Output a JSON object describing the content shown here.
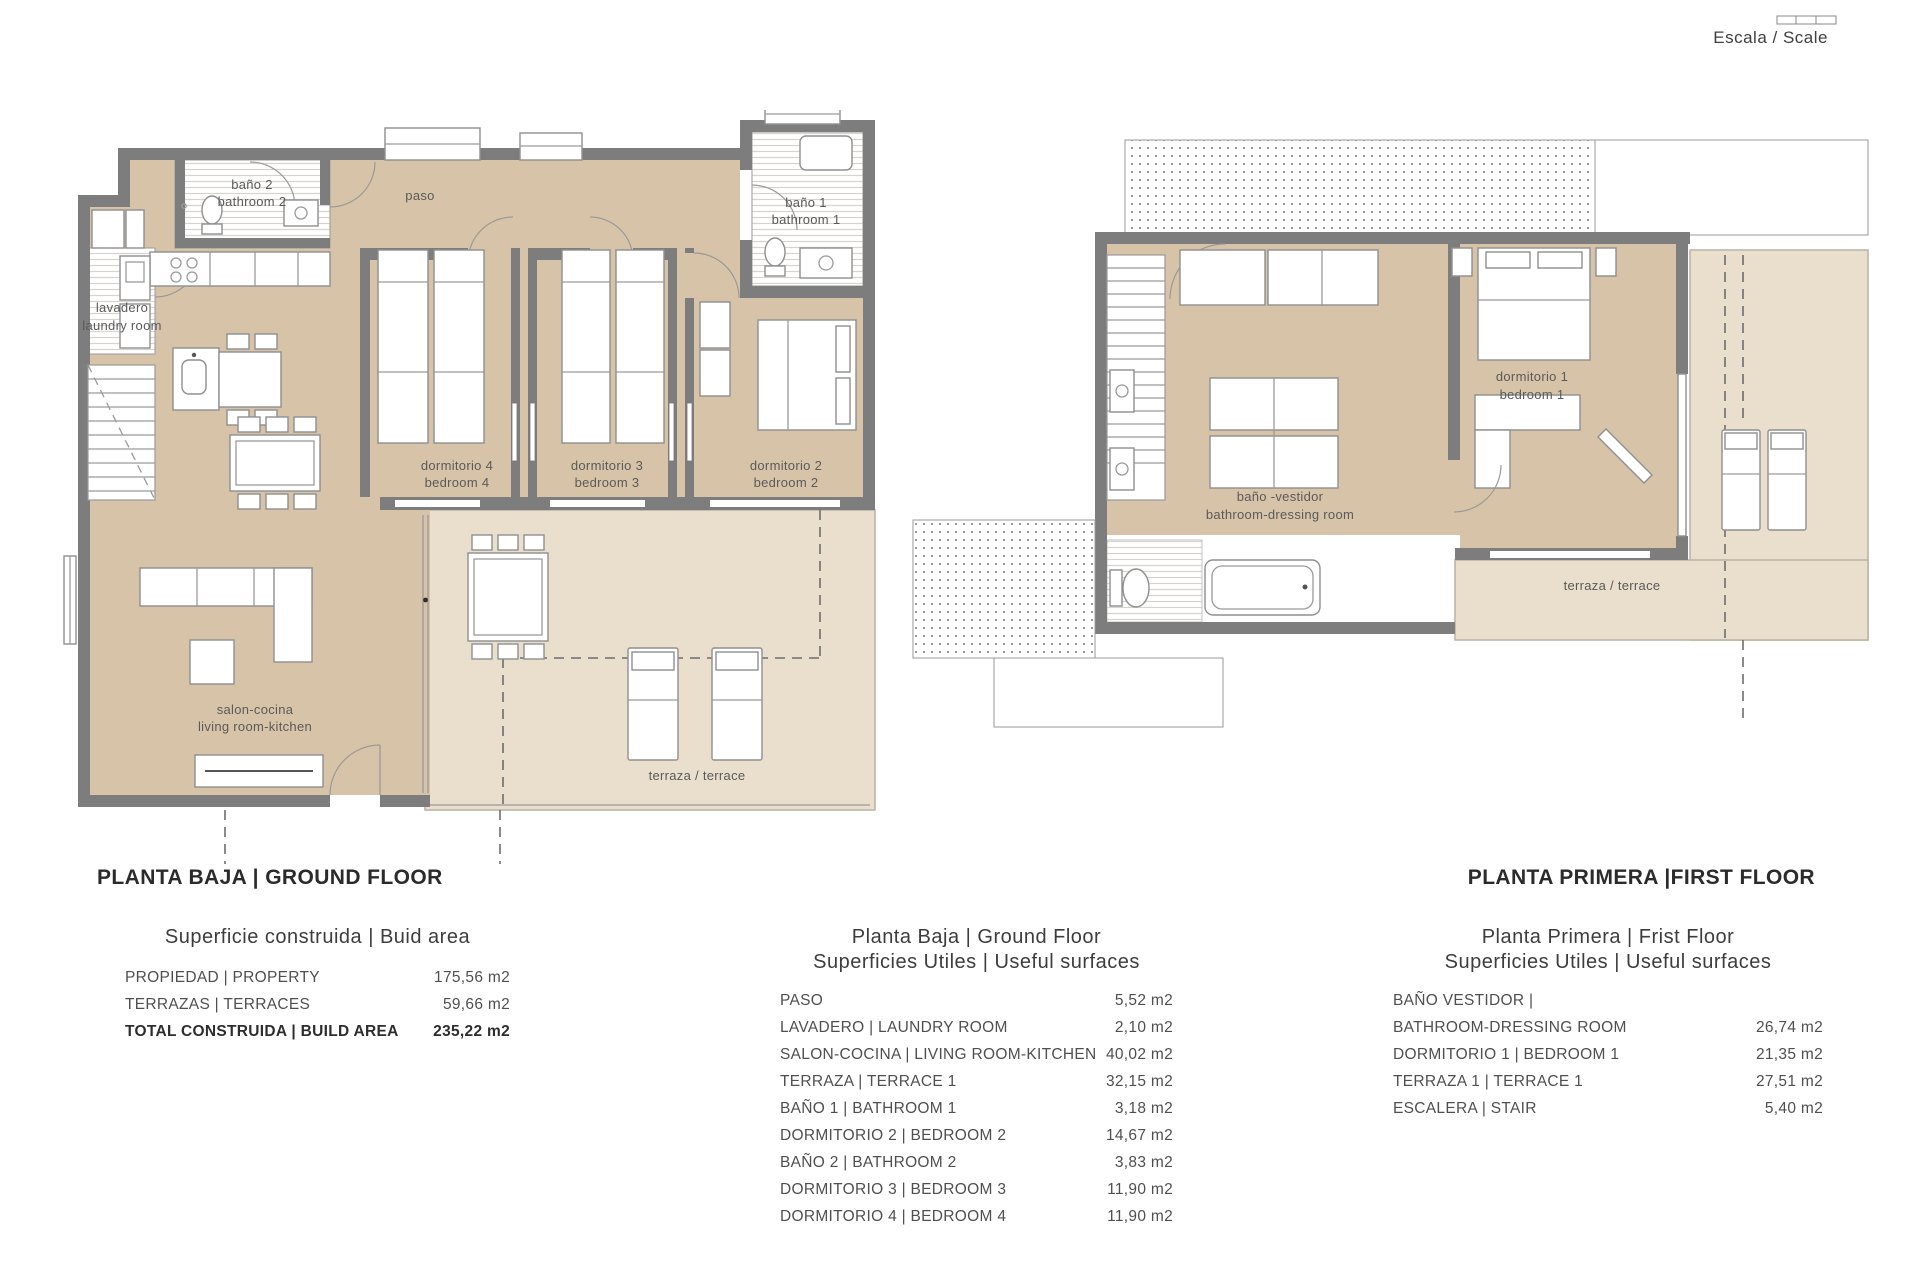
{
  "scale": {
    "label": "Escala / Scale"
  },
  "ground_floor": {
    "title": "PLANTA BAJA | GROUND FLOOR",
    "rooms": {
      "bath2": {
        "line1": "baño 2",
        "line2": "bathroom 2"
      },
      "paso": {
        "line1": "paso"
      },
      "bath1": {
        "line1": "baño 1",
        "line2": "bathroom 1"
      },
      "laundry": {
        "line1": "lavadero",
        "line2": "laundry room"
      },
      "bed4": {
        "line1": "dormitorio 4",
        "line2": "bedroom 4"
      },
      "bed3": {
        "line1": "dormitorio 3",
        "line2": "bedroom 3"
      },
      "bed2": {
        "line1": "dormitorio 2",
        "line2": "bedroom 2"
      },
      "living": {
        "line1": "salon-cocina",
        "line2": "living room-kitchen"
      },
      "terrace": {
        "line1": "terraza / terrace"
      }
    }
  },
  "first_floor": {
    "title": "PLANTA PRIMERA |FIRST FLOOR",
    "rooms": {
      "bath": {
        "line1": "baño -vestidor",
        "line2": "bathroom-dressing room"
      },
      "bed1": {
        "line1": "dormitorio 1",
        "line2": "bedroom 1"
      },
      "terrace": {
        "line1": "terraza / terrace"
      }
    }
  },
  "built_area_table": {
    "title": "Superficie construida | Buid area",
    "rows": [
      {
        "label": "PROPIEDAD | PROPERTY",
        "value": "175,56 m2"
      },
      {
        "label": "TERRAZAS | TERRACES",
        "value": "59,66 m2"
      },
      {
        "label": "TOTAL CONSTRUIDA | BUILD AREA",
        "value": "235,22 m2"
      }
    ]
  },
  "ground_useful_table": {
    "title_line1": "Planta Baja | Ground Floor",
    "title_line2": "Superficies Utiles | Useful surfaces",
    "rows": [
      {
        "label": "PASO",
        "value": "5,52 m2"
      },
      {
        "label": "LAVADERO | LAUNDRY ROOM",
        "value": "2,10 m2"
      },
      {
        "label": "SALON-COCINA | LIVING ROOM-KITCHEN",
        "value": "40,02 m2"
      },
      {
        "label": "TERRAZA | TERRACE 1",
        "value": "32,15 m2"
      },
      {
        "label": "BAÑO 1 | BATHROOM 1",
        "value": "3,18 m2"
      },
      {
        "label": "DORMITORIO 2 | BEDROOM 2",
        "value": "14,67 m2"
      },
      {
        "label": "BAÑO 2 | BATHROOM 2",
        "value": "3,83 m2"
      },
      {
        "label": "DORMITORIO 3 | BEDROOM 3",
        "value": "11,90 m2"
      },
      {
        "label": "DORMITORIO 4 | BEDROOM 4",
        "value": "11,90 m2"
      }
    ]
  },
  "first_useful_table": {
    "title_line1": "Planta Primera | Frist Floor",
    "title_line2": "Superficies Utiles | Useful surfaces",
    "rows": [
      {
        "label": "BAÑO VESTIDOR |",
        "value": ""
      },
      {
        "label": "BATHROOM-DRESSING ROOM",
        "value": "26,74 m2"
      },
      {
        "label": "DORMITORIO 1 | BEDROOM 1",
        "value": "21,35 m2"
      },
      {
        "label": "TERRAZA 1 | TERRACE 1",
        "value": "27,51 m2"
      },
      {
        "label": "ESCALERA | STAIR",
        "value": "5,40 m2"
      }
    ]
  },
  "colors": {
    "room_fill": "#d7c4a8",
    "terrace_fill": "#e9dfcc",
    "wall": "#7d7d7d"
  }
}
